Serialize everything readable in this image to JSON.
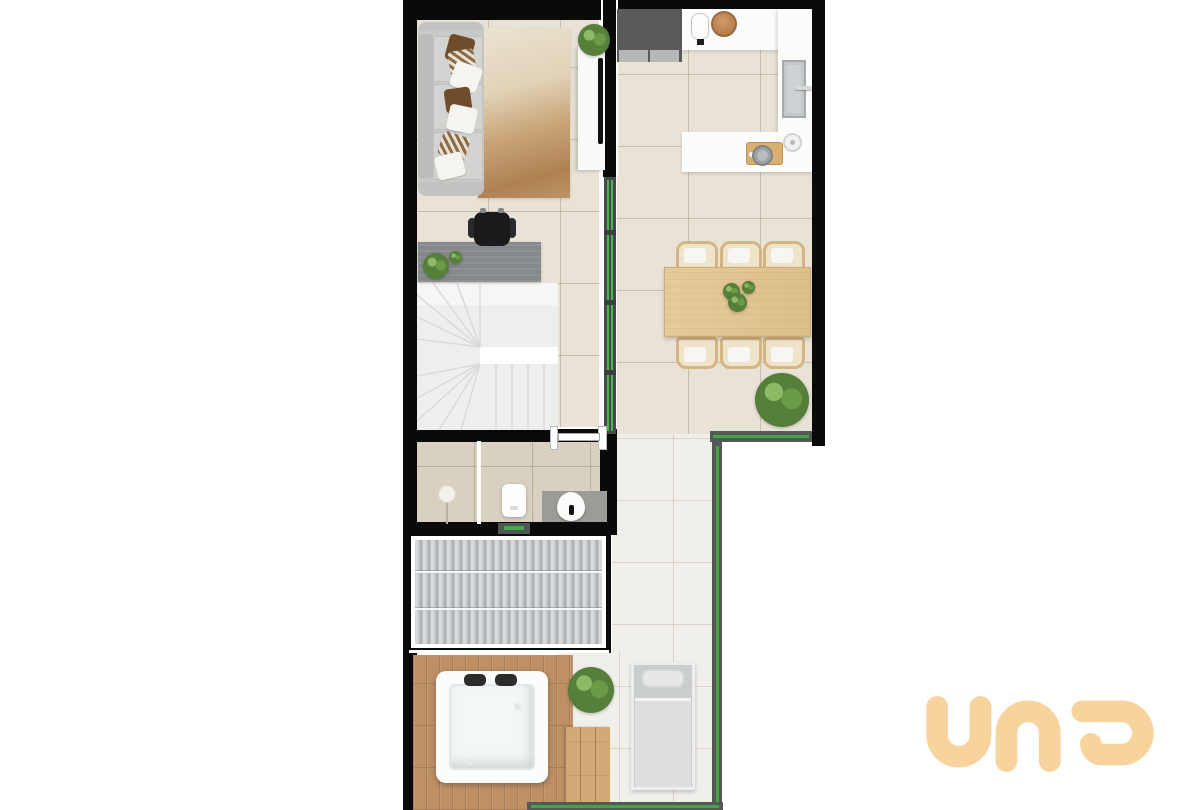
{
  "logo": {
    "text": "una",
    "color": "#F7D49E"
  },
  "palette": {
    "wall_black": "#0A0A0A",
    "trim_white": "#FFFFFF",
    "floor_tile_indoor": "#E9E3D7",
    "floor_tile_outdoor": "#F1EFE9",
    "floor_tile_bathroom": "#D8D0C1",
    "deck_wood": "#BE9064",
    "table_wood": "#E3C795",
    "roof_slats": "#C7CACC",
    "glass_partition_green": "#4EB253",
    "railing_green": "#43A546",
    "sofa_gray": "#C9C9C7",
    "desk_gray": "#85898B",
    "rug_brown": "#AE8152"
  },
  "legend": [
    "living-room",
    "home-office-desk",
    "winder-staircase",
    "bathroom",
    "kitchen",
    "dining-area",
    "covered-roof",
    "outdoor-deck",
    "hot-tub",
    "lounge-chair",
    "glass-partition",
    "glass-railing"
  ]
}
